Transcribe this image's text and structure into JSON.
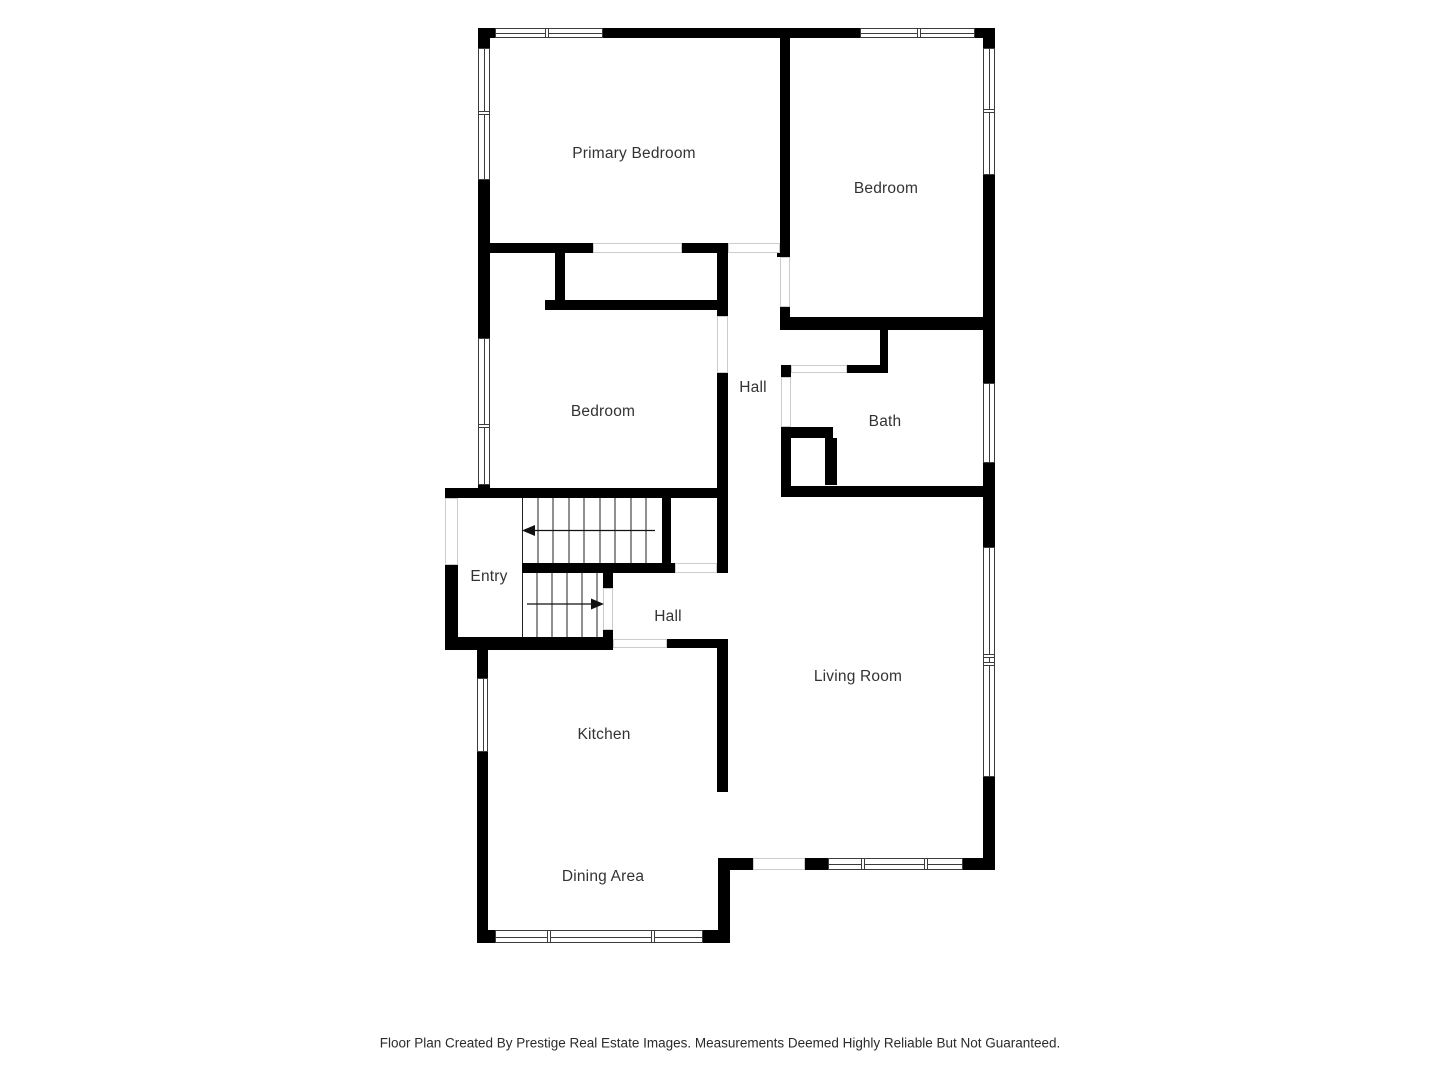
{
  "document": {
    "type": "residential floor plan",
    "footer": "Floor Plan Created By Prestige Real Estate Images. Measurements Deemed Highly Reliable But Not Guaranteed."
  },
  "rooms": [
    {
      "id": "primary-bedroom",
      "label": "Primary Bedroom"
    },
    {
      "id": "bedroom-top-right",
      "label": "Bedroom"
    },
    {
      "id": "bedroom-middle",
      "label": "Bedroom"
    },
    {
      "id": "hall-upper",
      "label": "Hall"
    },
    {
      "id": "bath",
      "label": "Bath"
    },
    {
      "id": "entry",
      "label": "Entry"
    },
    {
      "id": "hall-lower",
      "label": "Hall"
    },
    {
      "id": "living-room",
      "label": "Living Room"
    },
    {
      "id": "kitchen",
      "label": "Kitchen"
    },
    {
      "id": "dining-area",
      "label": "Dining Area"
    }
  ],
  "colors": {
    "wall": "#000000",
    "floor": "#ffffff",
    "opening_outline": "#cccccc",
    "text": "#333333"
  }
}
